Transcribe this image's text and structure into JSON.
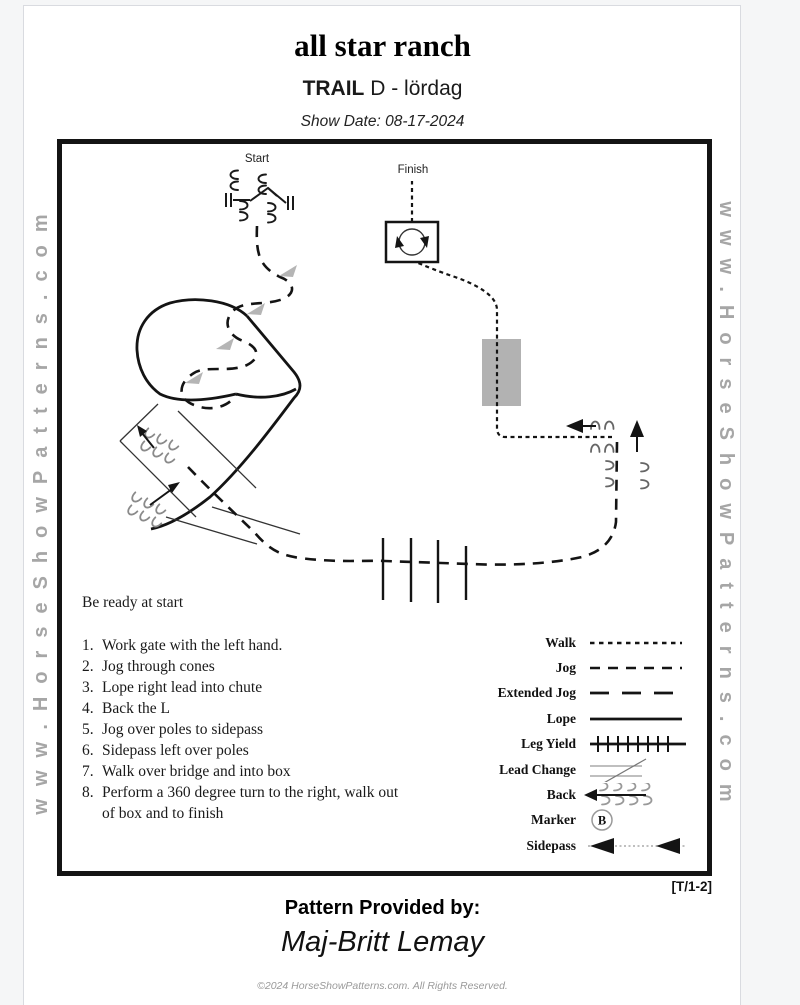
{
  "header": {
    "ranch_name": "all star ranch",
    "trail_label": "TRAIL",
    "class_name": "D - lördag",
    "show_date": "Show Date: 08-17-2024"
  },
  "watermark": {
    "text": "www.HorseShowPatterns.com"
  },
  "diagram": {
    "start_label": "Start",
    "finish_label": "Finish",
    "bridge_color": "#b2b2b2",
    "cone_color": "#b5b5b5"
  },
  "instructions": {
    "ready_note": "Be ready at start",
    "steps": [
      {
        "num": "1.",
        "text": "Work gate with the left hand."
      },
      {
        "num": "2.",
        "text": "Jog through cones"
      },
      {
        "num": "3.",
        "text": "Lope right lead into chute"
      },
      {
        "num": "4.",
        "text": "Back the L"
      },
      {
        "num": "5.",
        "text": "Jog over poles to sidepass"
      },
      {
        "num": "6.",
        "text": "Sidepass left over poles"
      },
      {
        "num": "7.",
        "text": "Walk over bridge and into box"
      },
      {
        "num": "8.",
        "text": "Perform a 360 degree turn to the right, walk out of box and to finish"
      }
    ]
  },
  "legend": {
    "items": [
      {
        "label": "Walk"
      },
      {
        "label": "Jog"
      },
      {
        "label": "Extended Jog"
      },
      {
        "label": "Lope"
      },
      {
        "label": "Leg Yield"
      },
      {
        "label": "Lead Change"
      },
      {
        "label": "Back"
      },
      {
        "label": "Marker"
      },
      {
        "label": "Sidepass"
      }
    ],
    "marker_letter": "B"
  },
  "footer": {
    "pattern_code": "[T/1-2]",
    "provided_by_label": "Pattern Provided by:",
    "provider_name": "Maj-Britt Lemay",
    "copyright": "©2024 HorseShowPatterns.com. All Rights Reserved."
  }
}
